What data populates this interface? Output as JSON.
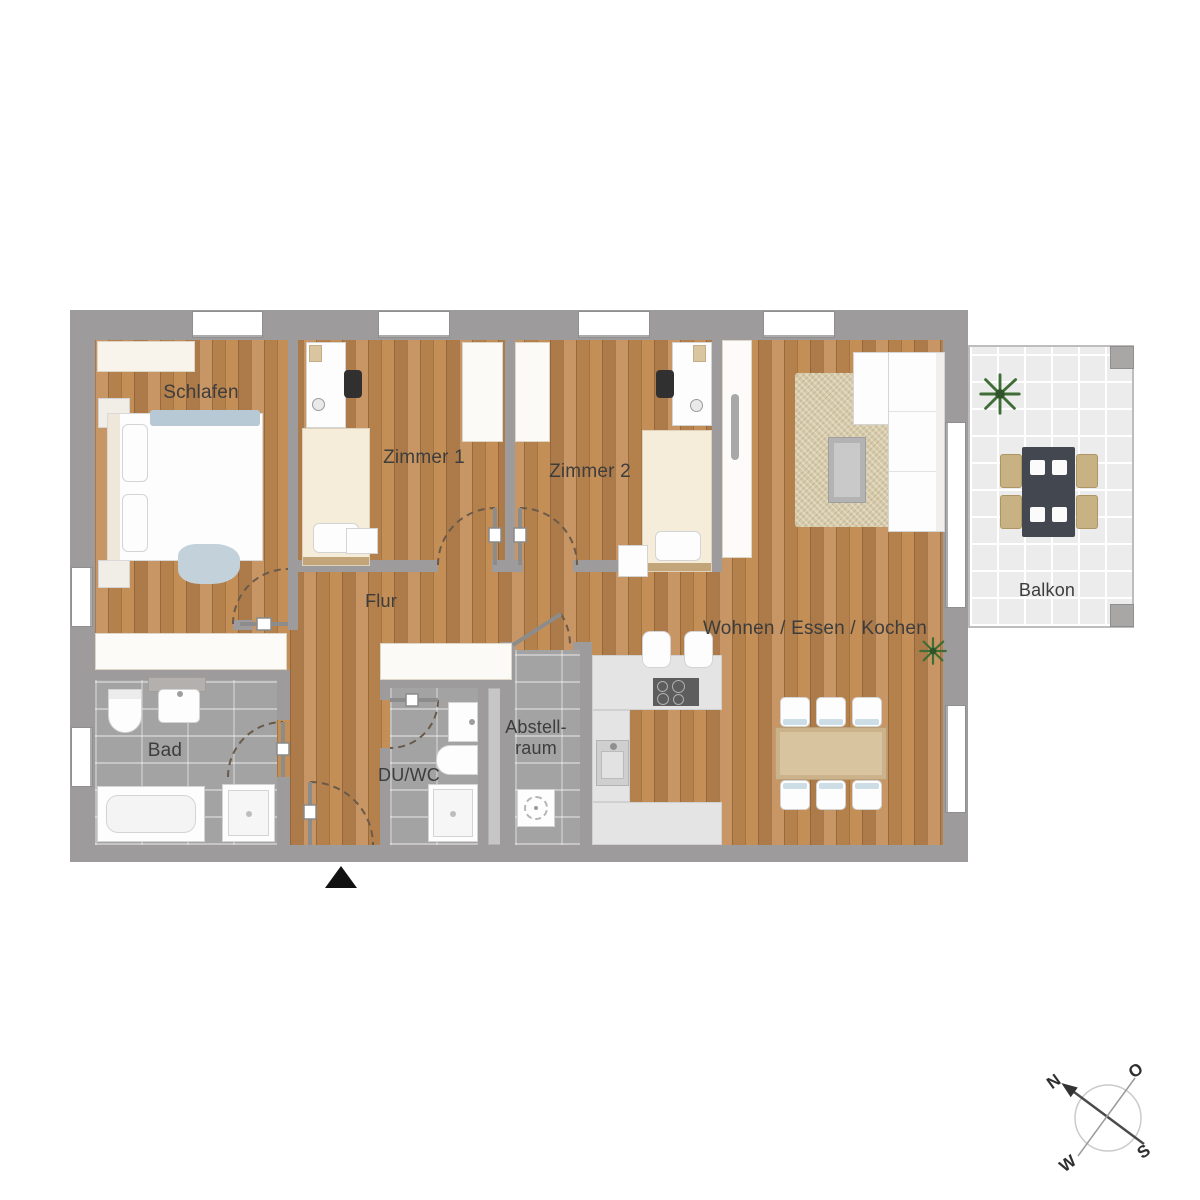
{
  "rooms": {
    "schlafen": "Schlafen",
    "zimmer1": "Zimmer 1",
    "zimmer2": "Zimmer 2",
    "flur": "Flur",
    "wohnen_essen_kochen": "Wohnen / Essen / Kochen",
    "bad": "Bad",
    "du_wc": "DU/WC",
    "abstellraum": {
      "line1": "Abstell-",
      "line2": "raum"
    },
    "balkon": "Balkon"
  },
  "compass": {
    "north": "N",
    "east": "O",
    "south": "S",
    "west": "W"
  },
  "icons": {
    "entrance_marker": "triangle-up",
    "compass_needle": "north-arrow",
    "plant": "potted-plant"
  },
  "colors": {
    "wall": "#9d9b9c",
    "wood": "#c28a52",
    "tile": "#a3a3a3",
    "balcony_floor": "#ececec",
    "counter": "#e4e4e4",
    "label": "#3d3d3d",
    "door_arc": "#6a5a4a"
  }
}
